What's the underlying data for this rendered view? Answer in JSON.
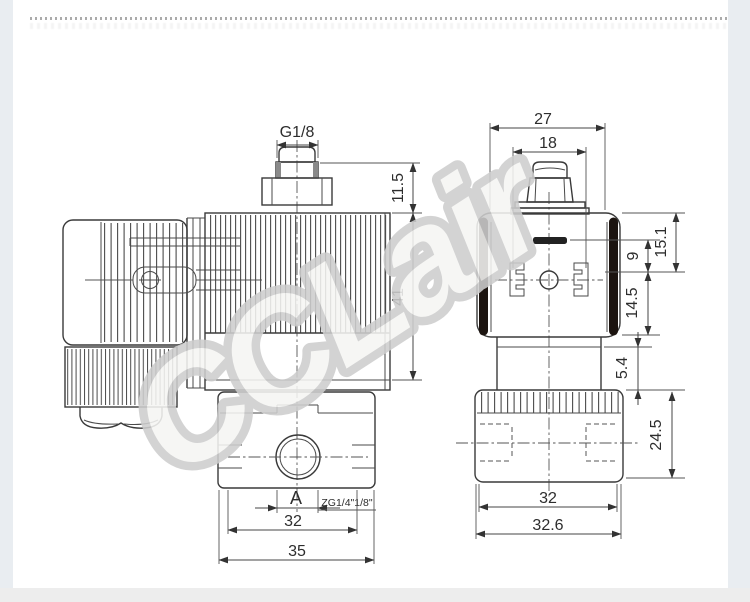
{
  "page": {
    "background": "#ffffff",
    "edge_strip_color": "#e9edf1",
    "bottom_strip_color": "#ededed",
    "line_color": "#3a3a3a",
    "gasket_bar_color": "#1c1410"
  },
  "watermark": {
    "text": "CCLair",
    "stroke_color": "#cdcdcd",
    "fill_color": "#f5f5f3"
  },
  "drawing": {
    "side_view": {
      "port_thread_label": "G1/8",
      "dim_stud_height": "11.5",
      "dim_coil_height": "41",
      "dim_port_span": "A",
      "thread_note": "ZG1/4\"1/8\"",
      "dim_body_inner_width": "32",
      "dim_body_width": "35"
    },
    "front_view": {
      "dim_connector_width": "27",
      "dim_pin_spacing": "18",
      "dim_top_to_center": "15.1",
      "dim_slot_to_center": "9",
      "dim_center_to_bottom": "14.5",
      "dim_gasket_height": "5.4",
      "dim_body_height": "24.5",
      "dim_body_inner_width": "32",
      "dim_body_width": "32.6"
    }
  }
}
